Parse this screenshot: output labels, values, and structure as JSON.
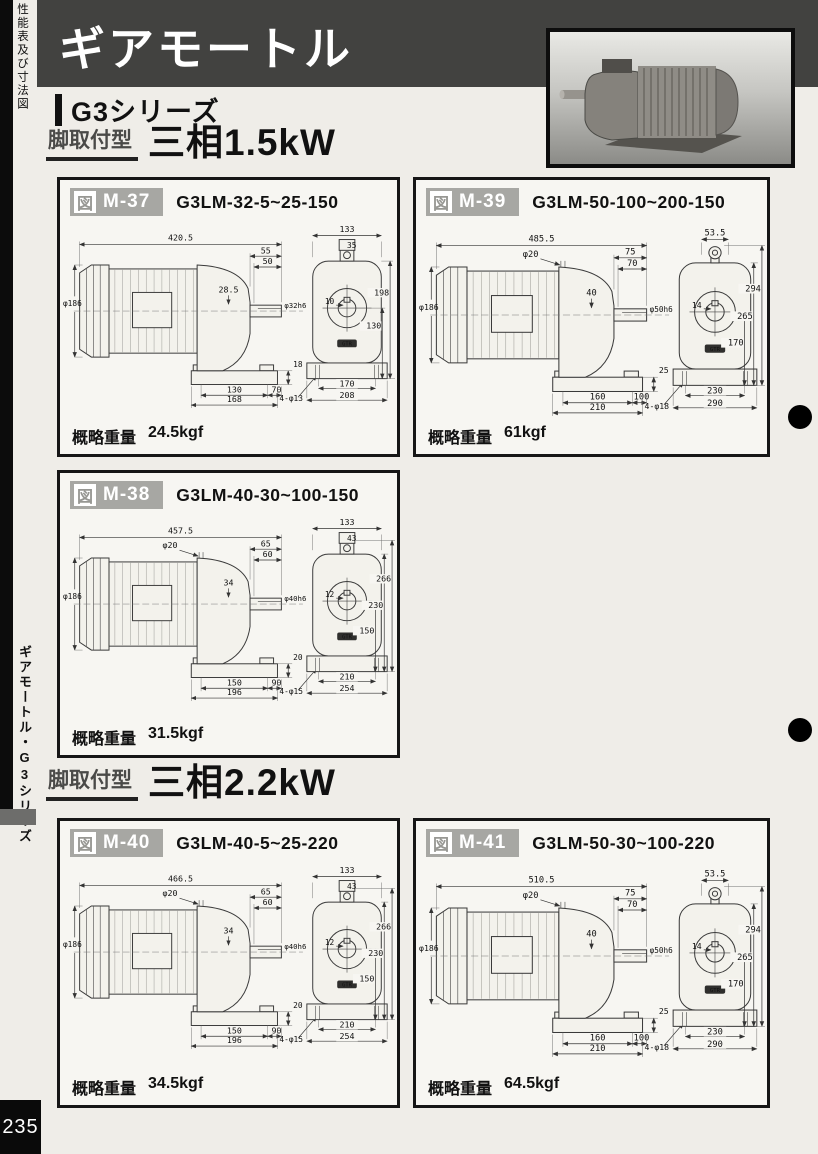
{
  "page": {
    "side_top_label": "性能表及び寸法図",
    "side_tab_label": "ギアモートル・G3シリーズ",
    "page_number": "235"
  },
  "header": {
    "title": "ギアモートル",
    "series": "G3シリーズ",
    "bar_color": "#424240"
  },
  "drawing_logo": "GTR",
  "sections": [
    {
      "badge": "脚取付型",
      "title": "三相1.5kW"
    },
    {
      "badge": "脚取付型",
      "title": "三相2.2kW"
    }
  ],
  "figures": [
    {
      "fig_prefix": "図",
      "fig_no": "M-37",
      "model": "G3LM-32-5~25-150",
      "weight_label": "概略重量",
      "weight_value": "24.5kgf",
      "dims": {
        "overall": "420.5",
        "tap": "",
        "w1": "55",
        "w2": "50",
        "setback": "28.5",
        "shaft": "φ32h6",
        "dia": "φ186",
        "foot_h": "18",
        "b1": "130",
        "b2": "70",
        "base": "168",
        "holes": "4-φ13",
        "top_w": "133",
        "eye": "35",
        "key": "10",
        "v1": "198",
        "v2": "130",
        "v3": "",
        "bb1": "170",
        "bb2": "208"
      }
    },
    {
      "fig_prefix": "図",
      "fig_no": "M-39",
      "model": "G3LM-50-100~200-150",
      "weight_label": "概略重量",
      "weight_value": "61kgf",
      "dims": {
        "overall": "485.5",
        "tap": "φ20",
        "w1": "75",
        "w2": "70",
        "setback": "40",
        "shaft": "φ50h6",
        "dia": "φ186",
        "foot_h": "25",
        "b1": "160",
        "b2": "100",
        "base": "210",
        "holes": "4-φ18",
        "top_w": "53.5",
        "eye": "",
        "key": "14",
        "v1": "294",
        "v2": "265",
        "v3": "170",
        "bb1": "230",
        "bb2": "290"
      }
    },
    {
      "fig_prefix": "図",
      "fig_no": "M-38",
      "model": "G3LM-40-30~100-150",
      "weight_label": "概略重量",
      "weight_value": "31.5kgf",
      "dims": {
        "overall": "457.5",
        "tap": "φ20",
        "w1": "65",
        "w2": "60",
        "setback": "34",
        "shaft": "φ40h6",
        "dia": "φ186",
        "foot_h": "20",
        "b1": "150",
        "b2": "90",
        "base": "196",
        "holes": "4-φ15",
        "top_w": "133",
        "eye": "43",
        "key": "12",
        "v1": "266",
        "v2": "230",
        "v3": "150",
        "bb1": "210",
        "bb2": "254"
      }
    },
    {
      "fig_prefix": "図",
      "fig_no": "M-40",
      "model": "G3LM-40-5~25-220",
      "weight_label": "概略重量",
      "weight_value": "34.5kgf",
      "dims": {
        "overall": "466.5",
        "tap": "φ20",
        "w1": "65",
        "w2": "60",
        "setback": "34",
        "shaft": "φ40h6",
        "dia": "φ186",
        "foot_h": "20",
        "b1": "150",
        "b2": "90",
        "base": "196",
        "holes": "4-φ15",
        "top_w": "133",
        "eye": "43",
        "key": "12",
        "v1": "266",
        "v2": "230",
        "v3": "150",
        "bb1": "210",
        "bb2": "254"
      }
    },
    {
      "fig_prefix": "図",
      "fig_no": "M-41",
      "model": "G3LM-50-30~100-220",
      "weight_label": "概略重量",
      "weight_value": "64.5kgf",
      "dims": {
        "overall": "510.5",
        "tap": "φ20",
        "w1": "75",
        "w2": "70",
        "setback": "40",
        "shaft": "φ50h6",
        "dia": "φ186",
        "foot_h": "25",
        "b1": "160",
        "b2": "100",
        "base": "210",
        "holes": "4-φ18",
        "top_w": "53.5",
        "eye": "",
        "key": "14",
        "v1": "294",
        "v2": "265",
        "v3": "170",
        "bb1": "230",
        "bb2": "290"
      }
    }
  ]
}
